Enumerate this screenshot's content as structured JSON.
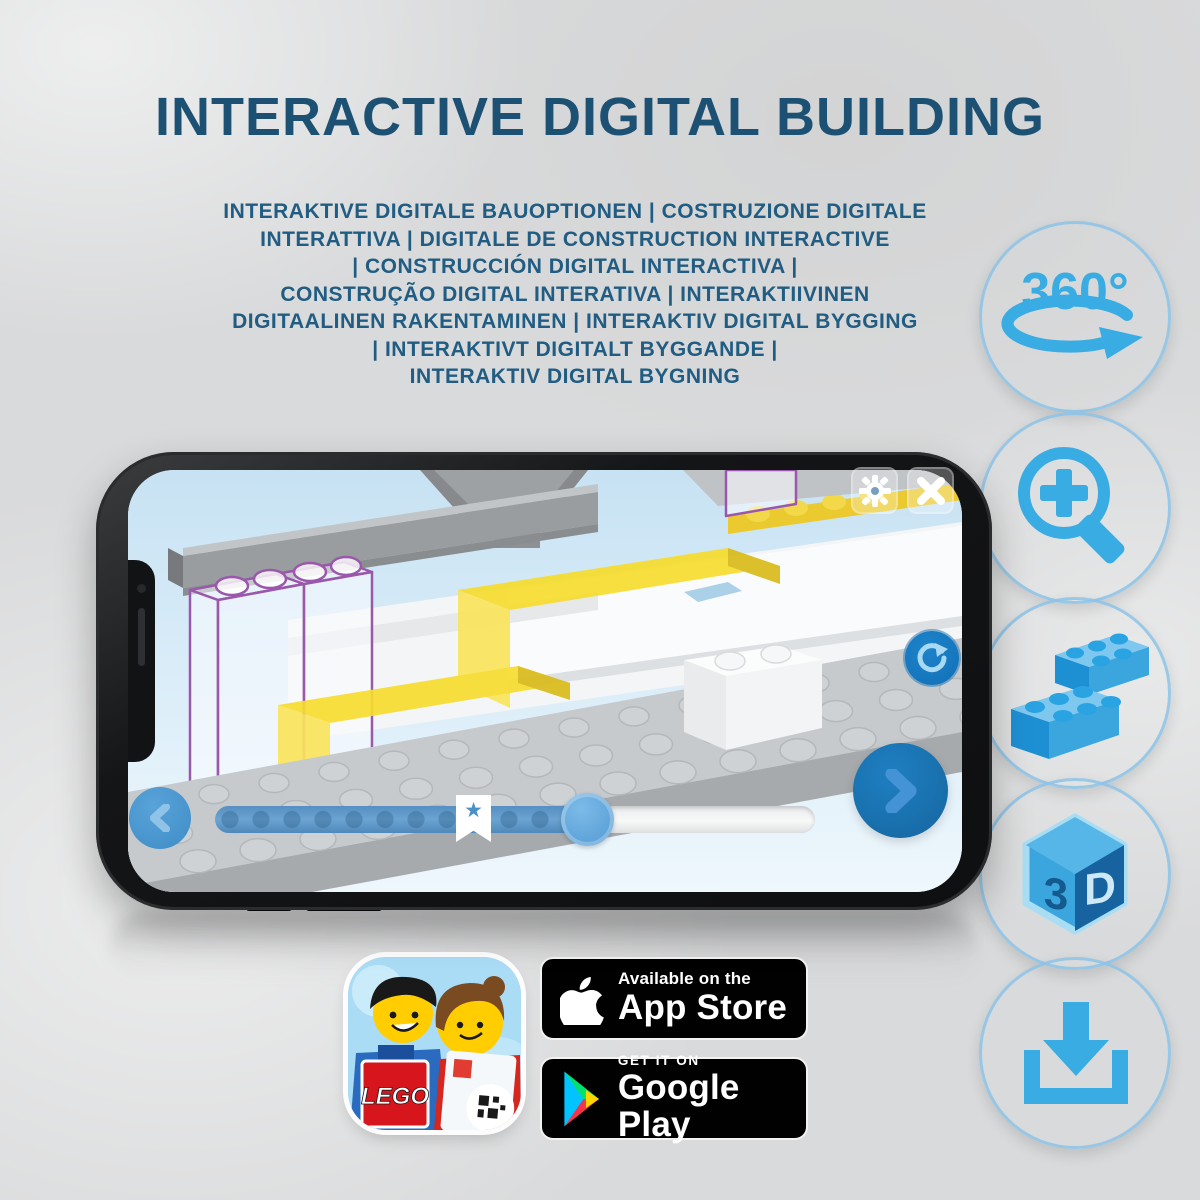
{
  "title": "INTERACTIVE DIGITAL BUILDING",
  "subtitle_lines": [
    "INTERAKTIVE DIGITALE BAUOPTIONEN | COSTRUZIONE DIGITALE",
    "INTERATTIVA | DIGITALE DE CONSTRUCTION INTERACTIVE",
    "| CONSTRUCCIÓN DIGITAL INTERACTIVA |",
    "CONSTRUÇÃO DIGITAL INTERATIVA | INTERAKTIIVINEN",
    "DIGITAALINEN RAKENTAMINEN | INTERAKTIV DIGITAL BYGGING",
    "| INTERAKTIVT DIGITALT BYGGANDE |",
    "INTERAKTIV DIGITAL BYGNING"
  ],
  "features": [
    {
      "id": "360-rotation",
      "label": "360°"
    },
    {
      "id": "zoom-in",
      "label": ""
    },
    {
      "id": "brick-stack",
      "label": ""
    },
    {
      "id": "3d-cube",
      "face_left": "3",
      "face_right": "D"
    },
    {
      "id": "download",
      "label": ""
    }
  ],
  "phone": {
    "slider": {
      "progress_percent": 62,
      "bookmark_percent": 43,
      "bookmark_glyph": "★"
    }
  },
  "badges": {
    "lego_app": {
      "logo_text": "LEGO"
    },
    "app_store": {
      "tagline": "Available on the",
      "store": "App Store"
    },
    "google_play": {
      "tagline": "GET IT ON",
      "store": "Google Play"
    }
  },
  "colors": {
    "title_blue": "#1d5174",
    "subtitle_blue": "#215c82",
    "circle_blue": "#1471b8",
    "icon_light_blue": "#39ace4",
    "slider_blue": "#5a96c8",
    "ghost_outline_purple": "#9a58ac",
    "brick_yellow": "#f6dd2e"
  }
}
